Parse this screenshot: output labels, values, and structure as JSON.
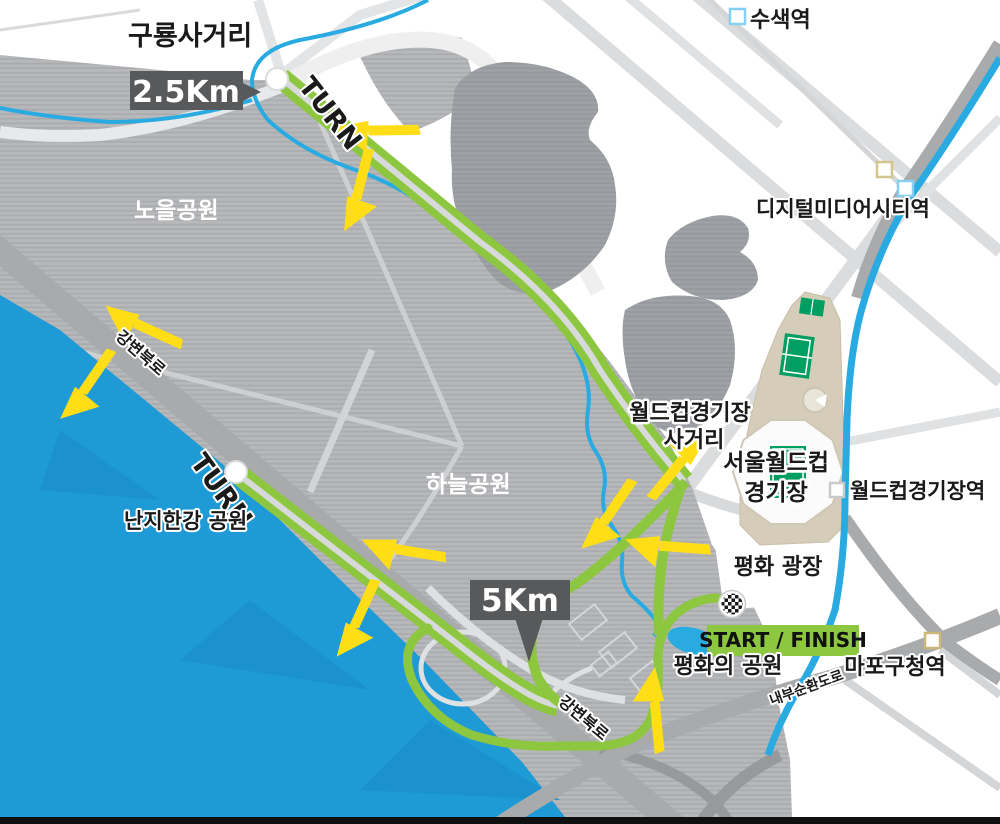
{
  "map": {
    "course_markers": {
      "km_2_5": "2.5Km",
      "km_5": "5Km",
      "start_finish": "START / FINISH",
      "turn": "TURN"
    },
    "places": {
      "guryong_intersection": "구룡사거리",
      "noeul_park": "노을공원",
      "haneul_park": "하늘공원",
      "nanji_hangang_park": "난지한강 공원",
      "worldcup_intersection_line1": "월드컵경기장",
      "worldcup_intersection_line2": "사거리",
      "seoul_worldcup_line1": "서울월드컵",
      "seoul_worldcup_line2": "경기장",
      "pyeonghwa_plaza": "평화 광장",
      "pyeonghwa_park": "평화의 공원"
    },
    "stations": {
      "susaek": "수색역",
      "dmc": "디지털미디어시티역",
      "worldcup_stadium": "월드컵경기장역",
      "mapo_gu_office": "마포구청역"
    },
    "roads": {
      "gangbyeon_expressway": "강변북로",
      "naebu_expressway": "내부순환도로"
    },
    "colors": {
      "route_green": "#8DC63F",
      "route_gap": "#D8D9DA",
      "arrow_yellow": "#FFDE17",
      "river_blue": "#1E9AD6",
      "stream_blue": "#29ABE2",
      "km_box_gray": "#58595B",
      "road_gray": "#A7A9AB",
      "park_gray": "#B6B8BA",
      "stadium_tan": "#D5CCB9",
      "pitch_green": "#009E60",
      "text_black": "#1A1A1A"
    },
    "arrows": [
      {
        "x": 378,
        "y": 140,
        "rot": -165
      },
      {
        "x": 368,
        "y": 192,
        "rot": 120
      },
      {
        "x": 140,
        "y": 336,
        "rot": -140
      },
      {
        "x": 96,
        "y": 390,
        "rot": 140
      },
      {
        "x": 403,
        "y": 560,
        "rot": -155
      },
      {
        "x": 367,
        "y": 622,
        "rot": 130
      },
      {
        "x": 670,
        "y": 460,
        "rot": -35
      },
      {
        "x": 617,
        "y": 520,
        "rot": 140
      },
      {
        "x": 668,
        "y": 556,
        "rot": -160
      },
      {
        "x": 646,
        "y": 712,
        "rot": -80
      }
    ],
    "station_markers": [
      {
        "x": 730,
        "y": 9,
        "s": 15,
        "c": "#86CFF1"
      },
      {
        "x": 877,
        "y": 162,
        "s": 15,
        "c": "#D3C58E"
      },
      {
        "x": 898,
        "y": 181,
        "s": 15,
        "c": "#86CFF1"
      },
      {
        "x": 830,
        "y": 483,
        "s": 14,
        "c": "#C8CACC"
      },
      {
        "x": 925,
        "y": 633,
        "s": 15,
        "c": "#CBB878"
      }
    ]
  }
}
